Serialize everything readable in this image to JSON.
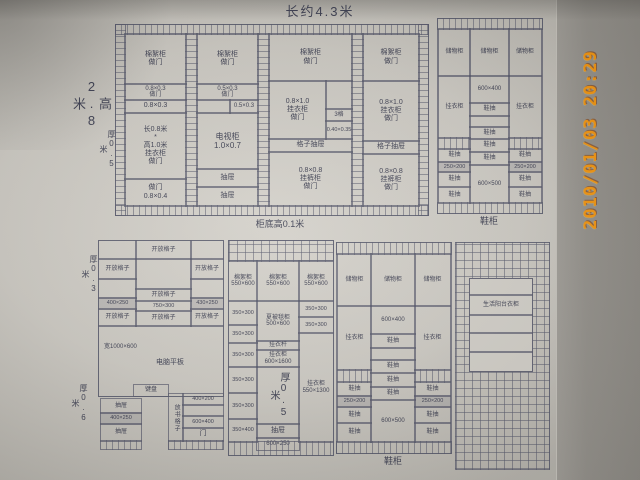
{
  "photo": {
    "timestamp": "2010/01/03 20:29"
  },
  "wardrobe": {
    "title": "长约4.3米",
    "height_label": "高2.8米",
    "depth_label": "厚0.5米",
    "base_label": "柜底高0.1米",
    "col1": {
      "r1": "棉絮柜\n做门",
      "r2": "0.8×0.3\n做门",
      "r3": "0.8×0.3",
      "r4": "长0.8米\n*\n高1.0米\n挂衣柜\n做门",
      "r5": "做门\n0.8×0.4"
    },
    "col2": {
      "r1": "棉絮柜\n做门",
      "r2a": "0.5×0.3\n做门",
      "r2b": "0.5×0.3",
      "r3": "电视柜\n1.0×0.7",
      "r4": "抽屉",
      "r5": "抽屉"
    },
    "col3": {
      "r1": "棉絮柜\n做门",
      "r2": "0.8×1.0\n挂衣柜\n做门",
      "s1": "3格",
      "s2": "0.40×0.35",
      "r3": "格子抽屉",
      "r4": "0.8×0.8\n挂裤柜\n做门"
    },
    "col4": {
      "r1": "棉絮柜\n做门",
      "r2": "0.8×1.0\n挂衣柜\n做门",
      "r3": "格子抽屉",
      "r4": "0.8×0.8\n挂裤柜\n做门"
    }
  },
  "shoe_top": {
    "caption": "鞋柜",
    "top_cell": "储物柜",
    "side_tall": "挂衣柜",
    "center_dim1": "600×400",
    "drawer": "鞋抽",
    "side_dim": "250×200",
    "center_dim2": "600×500"
  },
  "shoe_bottom": {
    "caption": "鞋柜",
    "top_cell": "储物柜",
    "side_tall": "挂衣柜",
    "center_dim1": "600×400",
    "drawer": "鞋抽",
    "side_dim": "250×200",
    "center_dim2": "600×500"
  },
  "desk": {
    "depth_top": "厚0.3米",
    "depth_bottom": "厚0.6米",
    "shelf": "开放格子",
    "dim_l": "400×250",
    "dim_c": "750×300",
    "dim_r": "430×250",
    "desk_note": "宽1000×600",
    "desk_label": "电脑平板",
    "keyboard": "键盘",
    "drawer": "抽屉",
    "drawer_dim": "400×250",
    "vert_label": "放书格子",
    "right_top": "400×200",
    "right_mid": "600×400",
    "right_door": "门"
  },
  "mid_cabinet": {
    "top_cell": "棉絮柜\n550×600",
    "dim_a": "350×300",
    "dim_b": "350×400",
    "quilt": "夏被毯柜\n500×600",
    "rod": "挂衣杆",
    "hang": "挂衣柜\n600×1600",
    "depth_note": "厚0.5米",
    "drawer": "抽屉",
    "bottom_dim": "600×250",
    "right_tall": "挂衣柜\n550×1300"
  },
  "balcony": {
    "label": "生活阳台衣柜"
  }
}
